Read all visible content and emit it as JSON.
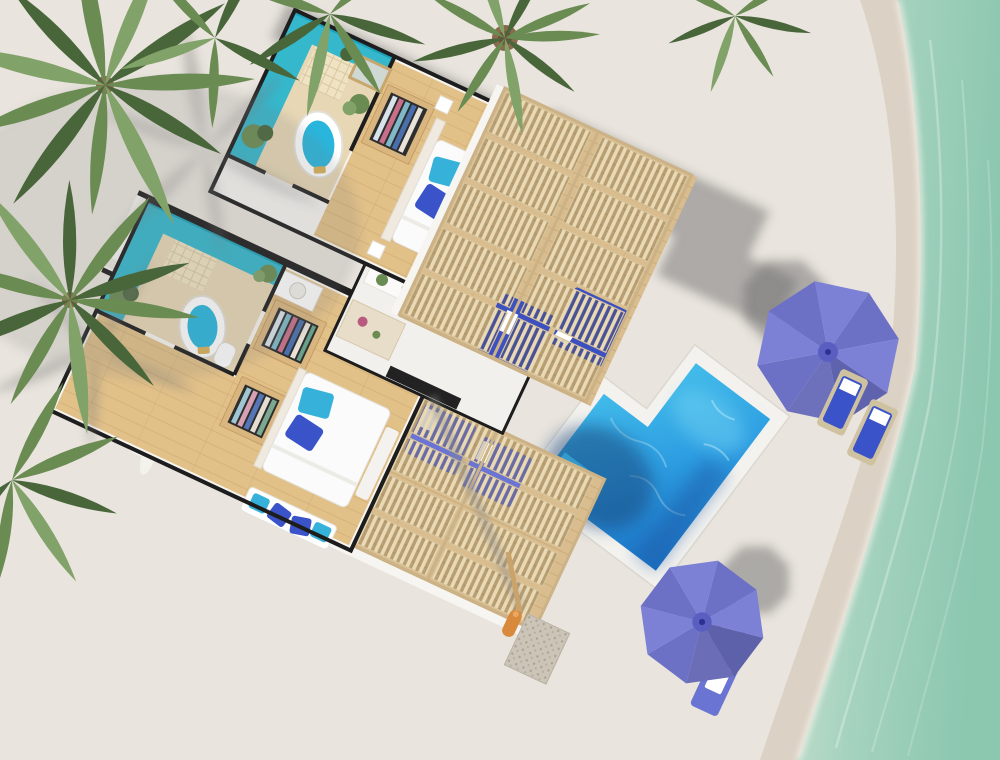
{
  "scene": {
    "type": "aerial 3D cutaway floor plan render",
    "setting": "beachfront twin-suite villa with pool, pergola decks, palm trees and shoreline",
    "rooms": [
      {
        "name": "upper-suite",
        "contents": [
          "turquoise-accent bathroom",
          "freestanding oval bathtub",
          "walk-in wardrobe",
          "double bed with blue pillows",
          "window seat with cushions"
        ]
      },
      {
        "name": "central-living",
        "contents": [
          "kitchen counter with plants",
          "tv-console",
          "island"
        ]
      },
      {
        "name": "lower-suite",
        "contents": [
          "turquoise-accent bathroom",
          "freestanding oval bathtub",
          "two wardrobes",
          "double bed with blue pillows",
          "daybed bench with pillows"
        ]
      }
    ],
    "outdoor": [
      "upper slatted pergola deck with two blue daybeds",
      "lower slatted pergola deck with two loungers",
      "L-shaped swimming pool",
      "outdoor shower with pebble mat",
      "two periwinkle beach umbrellas with sun loungers",
      "palm trees",
      "beach shoreline with sea"
    ],
    "counts": {
      "bedrooms": 2,
      "bathrooms": 2,
      "bathtubs": 2,
      "pergolas": 2,
      "beach_umbrellas": 2,
      "pools": 1,
      "palm_clusters": 6
    }
  },
  "palette": {
    "sand": "#e9e4dd",
    "wet_sand": "#d8cec0",
    "foam": "#f6f3ec",
    "ocean_shallow": "#cfe3d4",
    "ocean": "#a6d3bf",
    "ocean_deep": "#8cc7b0",
    "wall_white": "#f7f5f1",
    "wall_cut": "#1d1d1d",
    "shadow_gray": "#6f6f6f",
    "turquoise": "#35b7cc",
    "turquoise_dark": "#1fa0b8",
    "bath_floor": "#e7d7b5",
    "tile": "#efe3c4",
    "tub_water": "#29b6dd",
    "wood_floor": "#e2c189",
    "wood_line": "#c9a76f",
    "deck_wood": "#d9bd8e",
    "deck_line": "#c2a06c",
    "pergola_slat": "#e9d9b4",
    "pergola_frame": "#cbb287",
    "pool_light": "#4ecbee",
    "pool_mid": "#2e9fe2",
    "pool_deep": "#1b6ec2",
    "pool_shadow": "#123f75",
    "coping": "#f4f2ee",
    "bed_white": "#fbfbfb",
    "pillow_cyan": "#36b2da",
    "pillow_blue": "#3a53c8",
    "daybed_blue": "#3c50c0",
    "lounger_violet": "#6a74d2",
    "umbrella": "#7d81d6",
    "umbrella_dark": "#6d71c6",
    "umbrella_center": "#5a5ec0",
    "palm_green": "#6a8b52",
    "palm_dark": "#49663a",
    "palm_light": "#81a268",
    "trunk": "#8a6a4c",
    "wardrobe_wood": "#d9b67f",
    "mat_pebble": "#ccc5b7"
  }
}
